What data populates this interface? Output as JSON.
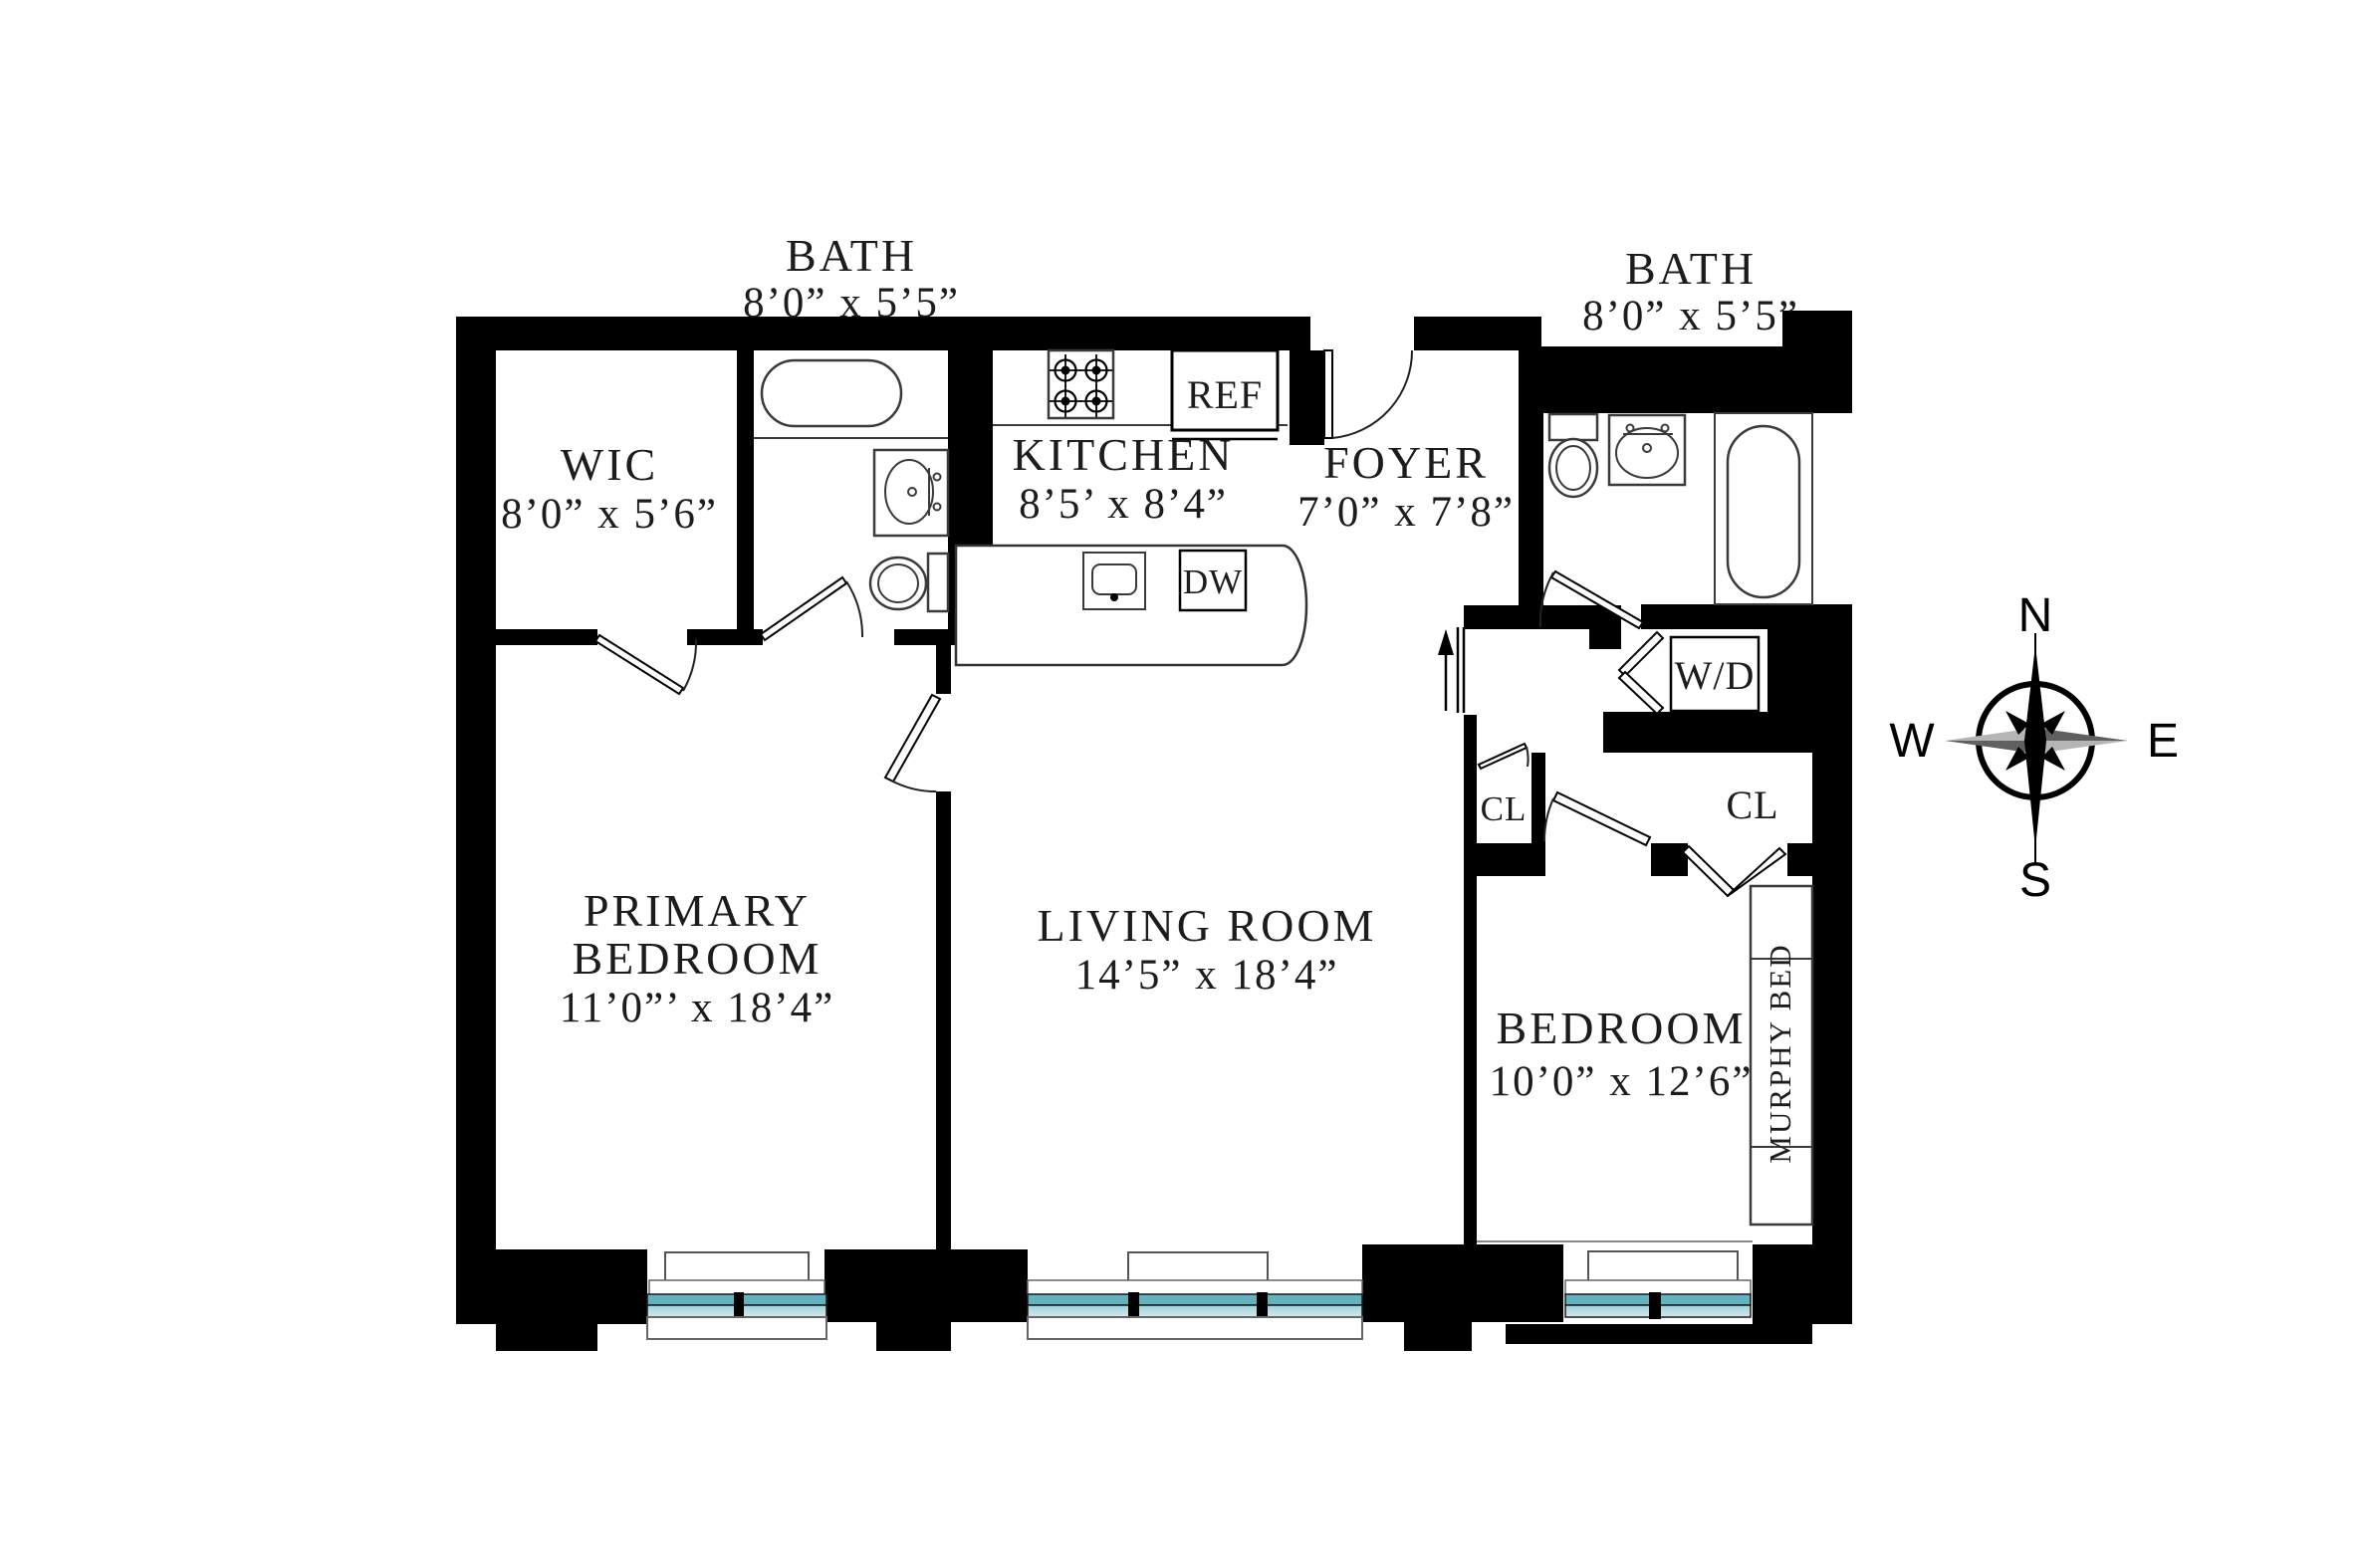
{
  "title": "apartment floor plan",
  "rooms": [
    {
      "id": "wic",
      "name": "WIC",
      "dims": "8’0” x 5’6”"
    },
    {
      "id": "bath-left",
      "name": "BATH",
      "dims": "8’0” x 5’5”"
    },
    {
      "id": "kitchen",
      "name": "KITCHEN",
      "dims": "8’5’ x 8’4”"
    },
    {
      "id": "foyer",
      "name": "FOYER",
      "dims": "7’0” x 7’8”"
    },
    {
      "id": "bath-right",
      "name": "BATH",
      "dims": "8’0” x 5’5”"
    },
    {
      "id": "primary-bedroom",
      "name_line1": "PRIMARY",
      "name_line2": "BEDROOM",
      "dims": "11’0”’ x 18’4”"
    },
    {
      "id": "living-room",
      "name": "LIVING ROOM",
      "dims": "14’5” x 18’4”"
    },
    {
      "id": "bedroom",
      "name": "BEDROOM",
      "dims": "10’0” x 12’6”"
    }
  ],
  "fixtures": {
    "refrigerator": "REF",
    "dishwasher": "DW",
    "washer_dryer": "W/D",
    "closet_hall": "CL",
    "closet_bedroom": "CL",
    "murphy_bed": "MURPHY BED"
  },
  "compass": {
    "north": "N",
    "east": "E",
    "south": "S",
    "west": "W"
  },
  "colors": {
    "wall": "#000000",
    "window_glass_dark": "#62b2bf",
    "window_glass_light": "#a9d5db",
    "line": "#3a3a3a",
    "text": "#1c1c1c"
  }
}
